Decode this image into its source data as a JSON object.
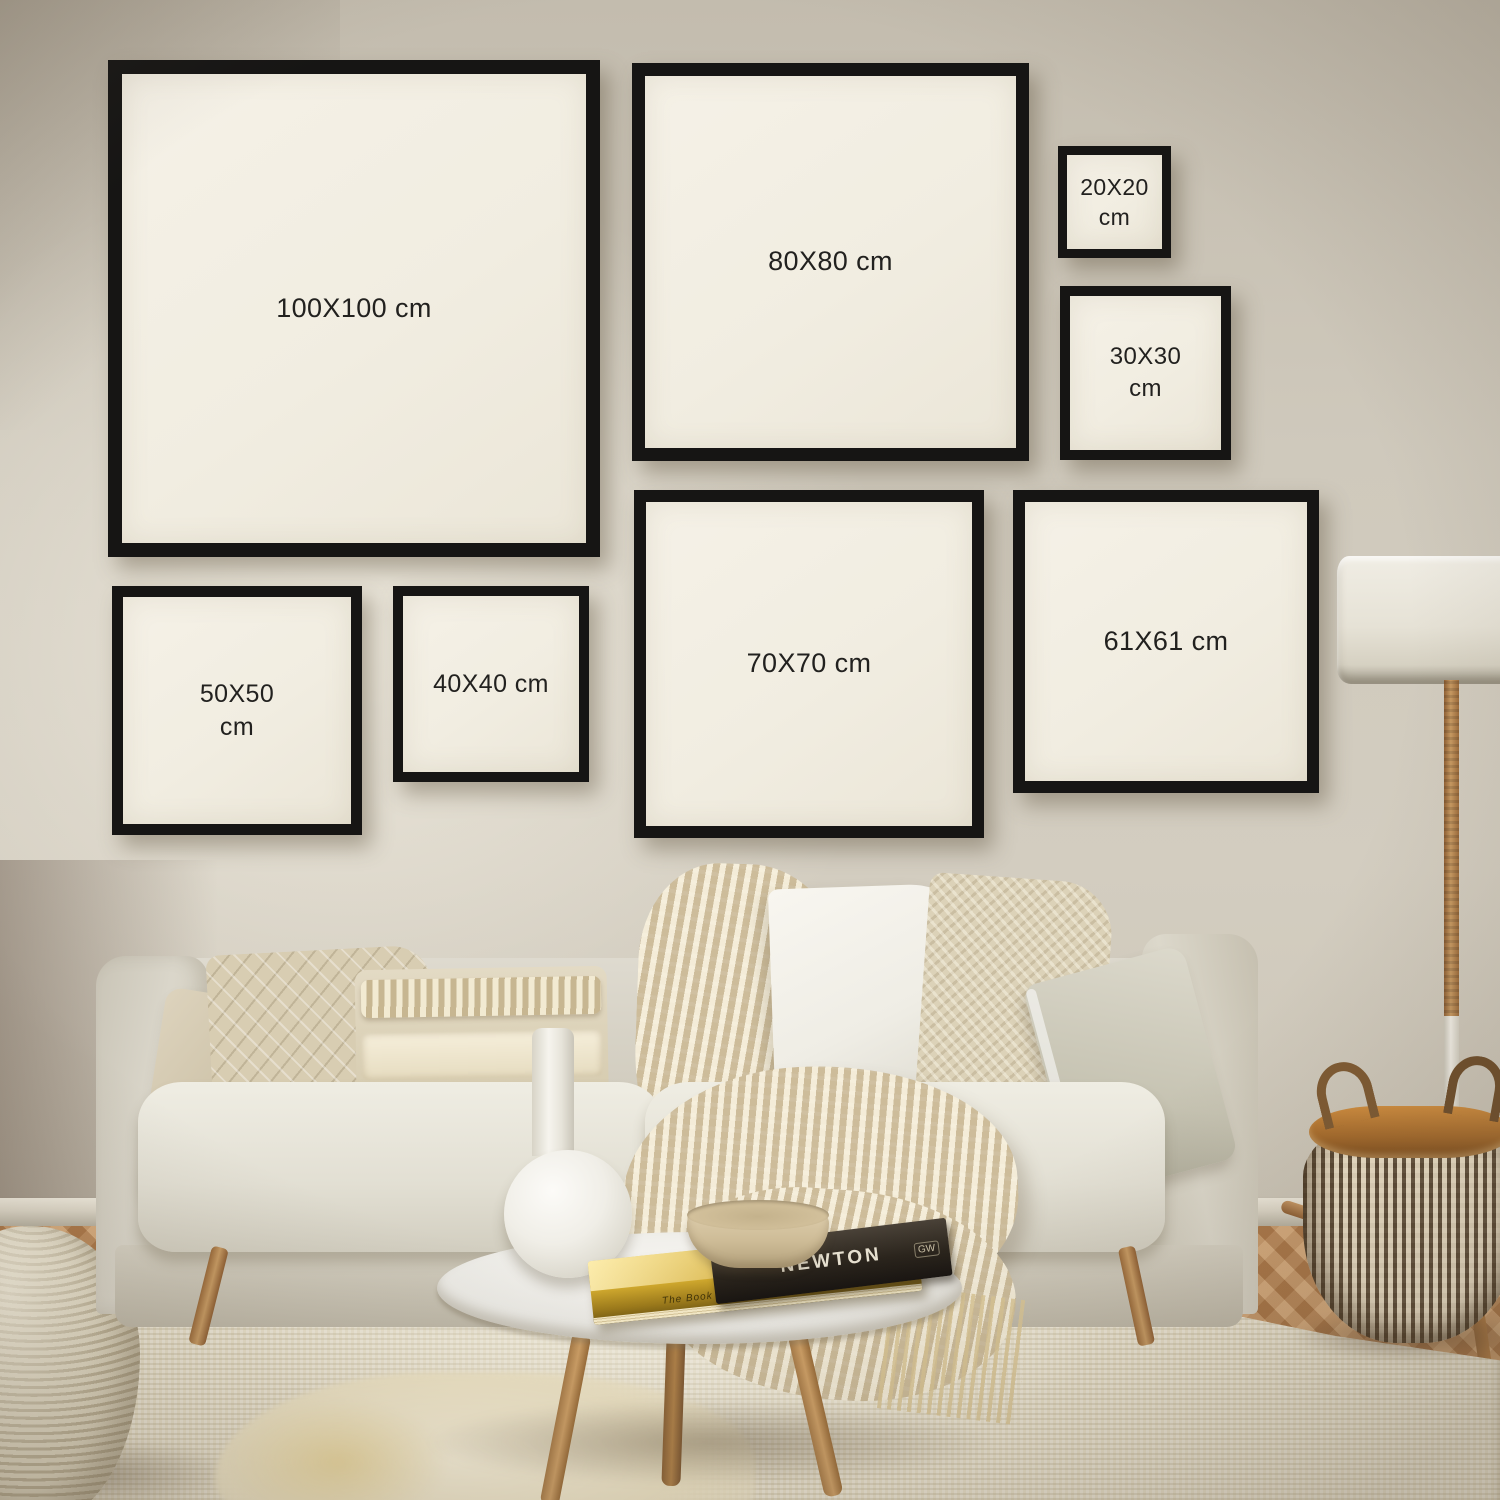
{
  "frames": [
    {
      "size": "100X100",
      "label": "100X100 cm"
    },
    {
      "size": "80X80",
      "label": "80X80 cm"
    },
    {
      "size": "20X20",
      "label": "20X20 cm"
    },
    {
      "size": "30X30",
      "label": "30X30 cm"
    },
    {
      "size": "50X50",
      "label": "50X50 cm"
    },
    {
      "size": "40X40",
      "label": "40X40 cm"
    },
    {
      "size": "70X70",
      "label": "70X70 cm"
    },
    {
      "size": "61X61",
      "label": "61X61 cm"
    }
  ],
  "books": {
    "dark_book_spine": "NEWTON",
    "dark_book_publisher": "GW",
    "gold_book_spine_small": "The Book Of",
    "gold_book_spine": "TRANSFORMATION"
  },
  "colors": {
    "frame_border": "#161514",
    "frame_mat": "#f2eee3",
    "label_text": "#22211f",
    "wall": "#ccc6b9",
    "sofa_fabric": "#dcd8cc",
    "rug": "#e8e0ca",
    "floor_wood": "#c08a58",
    "basket_brown": "#5e4b35",
    "basket_rim": "#a4692a",
    "lamp_shade": "#eae6db",
    "gold_book": "#d4ac2e"
  }
}
